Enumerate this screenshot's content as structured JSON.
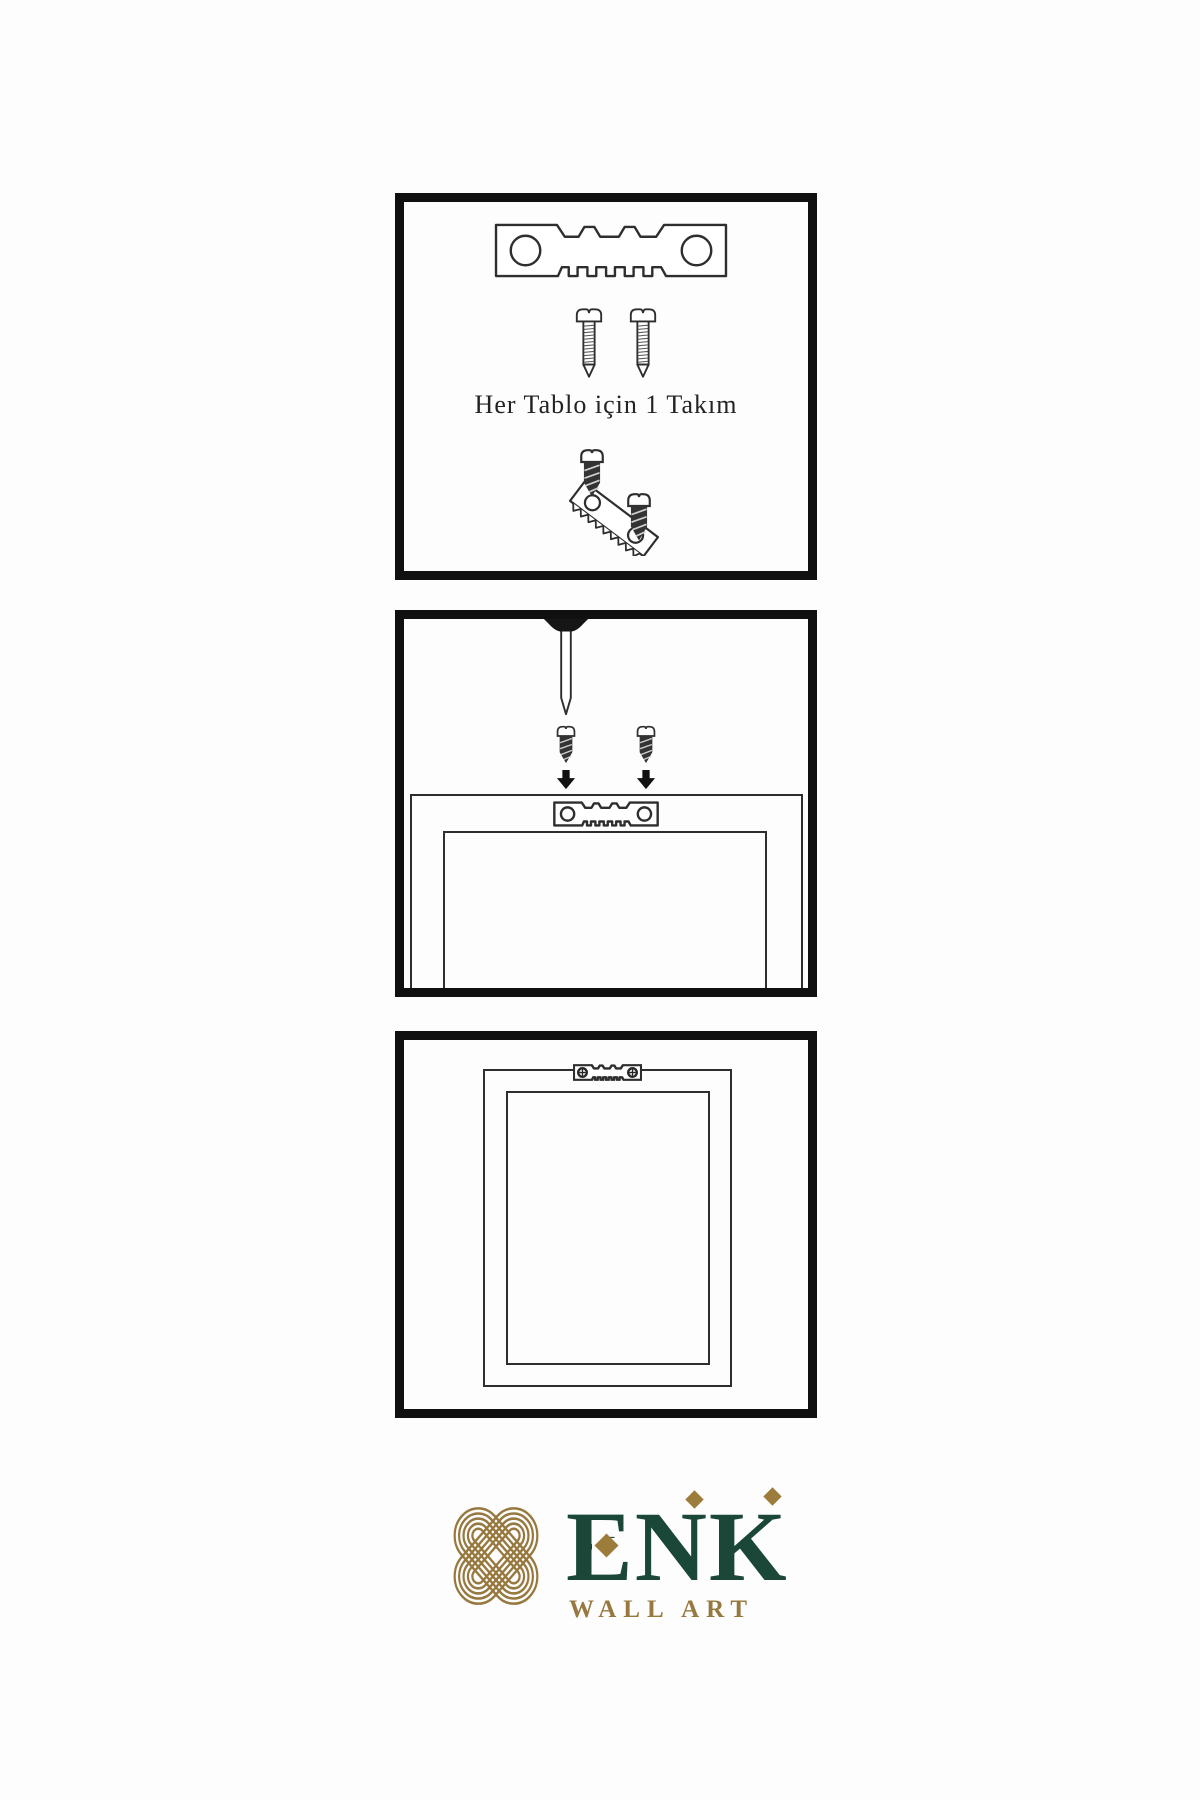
{
  "colors": {
    "background": "#fdfdfd",
    "panel_border": "#101010",
    "line_art": "#2e2e2e",
    "screw_dark_fill": "#333333",
    "brand_green": "#1a4738",
    "brand_gold": "#97793f",
    "accent_gold": "#9c7c3a"
  },
  "steps": [
    {
      "id": "hardware-kit",
      "caption": "Her Tablo için 1 Takım",
      "icons": [
        "sawtooth-hanger-icon",
        "screw-icon",
        "screw-icon",
        "screw-into-hanger-icon"
      ]
    },
    {
      "id": "wall-nail-and-screws",
      "icons": [
        "nail-icon",
        "screw-icon",
        "screw-icon",
        "down-arrow-icon",
        "down-arrow-icon",
        "sawtooth-hanger-icon",
        "frame-back-icon"
      ]
    },
    {
      "id": "hanging-result",
      "icons": [
        "sawtooth-hanger-with-screws-icon",
        "frame-back-icon"
      ]
    }
  ],
  "logo": {
    "brand": "ENK",
    "brand_letters": [
      "E",
      "N",
      "K"
    ],
    "subtitle": "WALL ART",
    "emblem": "knot-logo-icon"
  }
}
